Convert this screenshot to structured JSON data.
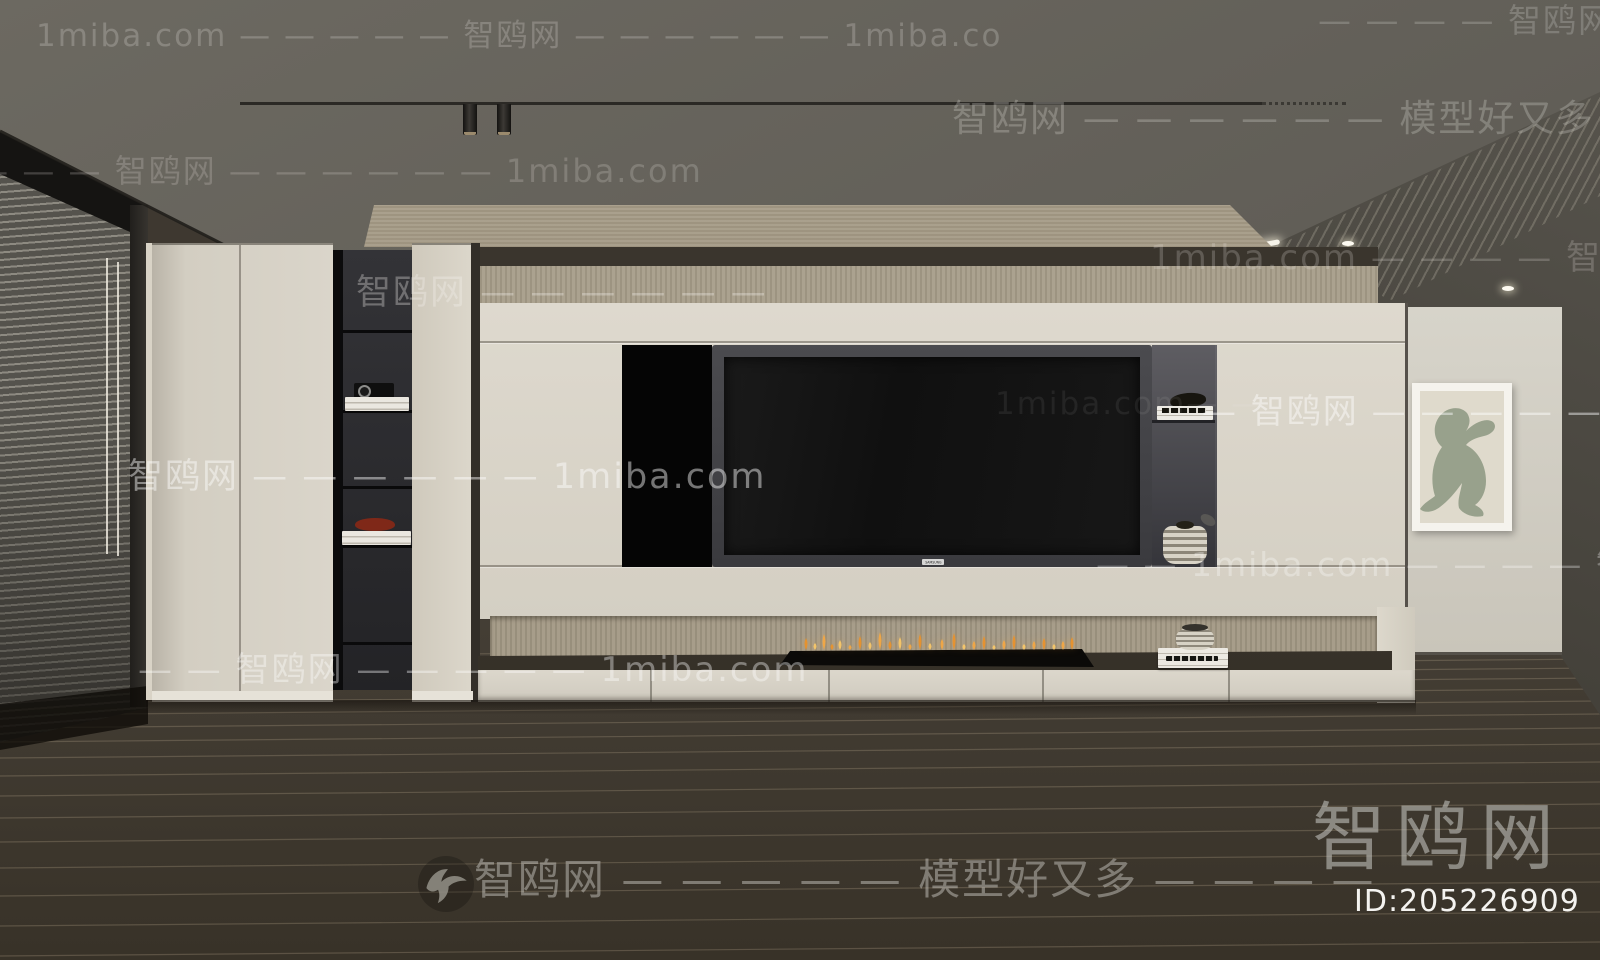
{
  "branding": {
    "logo_text": "智鸥网",
    "model_id": "ID:205226909",
    "site_name": "智鸥网",
    "site_url": "1miba.com",
    "tagline": "模型好又多"
  },
  "tv": {
    "brand_label": "SAMSUNG"
  },
  "icons": {
    "bird_logo_icon": "seagull-silhouette"
  },
  "watermarks": {
    "instances": [
      {
        "text": "1miba.com — — — — — 智鸥网 — — — — — — 1miba.co",
        "x": 36,
        "y": 10,
        "size": 31,
        "color": "rgba(223,221,216,0.26)"
      },
      {
        "text": "— — — — 智鸥网",
        "x": 1318,
        "y": -6,
        "size": 33,
        "color": "rgba(223,221,216,0.24)"
      },
      {
        "text": "智鸥网 — — — — — — 模型好又多 — — — —",
        "x": 952,
        "y": 88,
        "size": 37,
        "color": "rgba(226,224,218,0.27)"
      },
      {
        "text": "— — — — 智鸥网 — — — — — — 1miba.com",
        "x": -70,
        "y": 146,
        "size": 32,
        "color": "rgba(226,224,218,0.22)"
      },
      {
        "text": "智鸥网 — — — — — —",
        "x": 356,
        "y": 264,
        "size": 35,
        "color": "rgba(245,243,238,0.32)"
      },
      {
        "text": "1miba.com — — — — 智鸥网 — — — — 智鸥网",
        "x": 1150,
        "y": 230,
        "size": 34,
        "color": "rgba(230,228,222,0.22)"
      },
      {
        "text": "智鸥网 — — — — — — 1miba.com",
        "x": 128,
        "y": 448,
        "size": 35,
        "color": "rgba(255,255,255,0.45)"
      },
      {
        "text": "1miba.com— —",
        "x": 995,
        "y": 386,
        "size": 31,
        "color": "rgba(255,255,255,0.07)"
      },
      {
        "text": "— 智鸥网 — — — — — — 1miba.com",
        "x": 1202,
        "y": 384,
        "size": 34,
        "color": "rgba(255,255,255,0.45)"
      },
      {
        "text": "— — 1miba.com — — — — 智鸥网 — —",
        "x": 1096,
        "y": 538,
        "size": 33,
        "color": "rgba(255,255,255,0.30)"
      },
      {
        "text": "— — 智鸥网 — — — — — 1miba.com",
        "x": 138,
        "y": 642,
        "size": 34,
        "color": "rgba(255,255,255,0.38)"
      },
      {
        "text": "智鸥网 — — — — — 模型好又多 — — — —",
        "x": 474,
        "y": 846,
        "size": 42,
        "color": "rgba(198,196,190,0.5)"
      }
    ]
  },
  "palette": {
    "ceiling": "#625f58",
    "floor": "#3e3830",
    "floor_line": "#a8997f",
    "cream_panel": "#d8d3c7",
    "wood_trim": "#a0967f",
    "counter_dark": "#37322b",
    "niche_dark": "#2a2a2c",
    "tv_frame": "#414145",
    "tv_screen": "#131313",
    "right_wall": "#d0ccc2",
    "artwork_green": "#98a18c",
    "artwork_mat": "#dfdacc",
    "flame_primary": "#e8922c",
    "flame_highlight": "#f8c768",
    "blinds": "#504e49",
    "accent_red_bowl": "#7f2818"
  }
}
